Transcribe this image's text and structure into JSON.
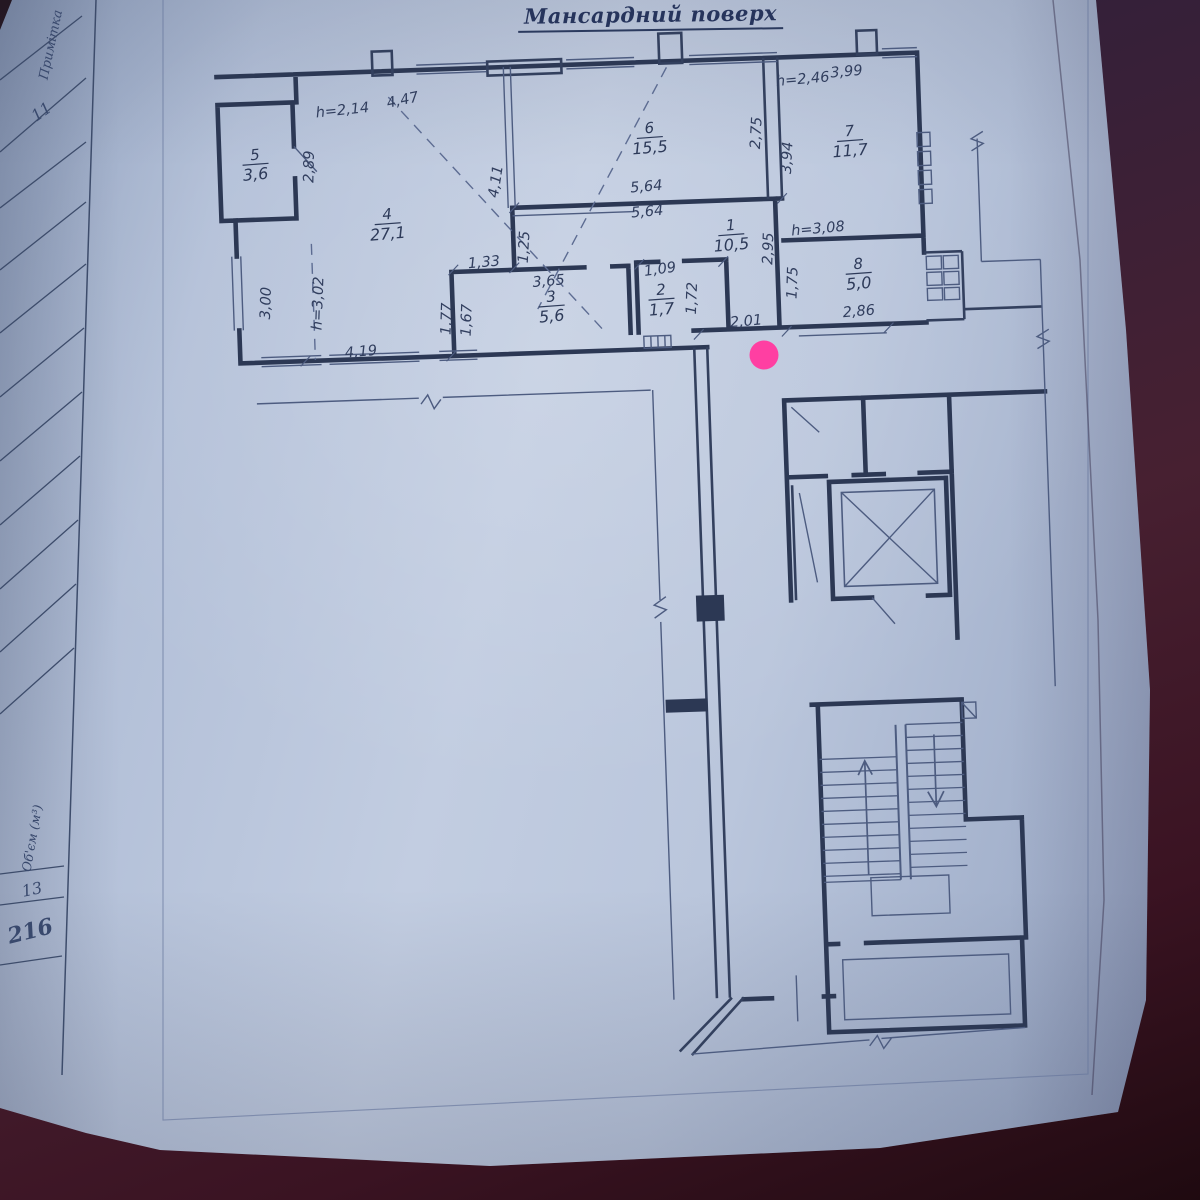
{
  "page": {
    "title": "Мансардний поверх"
  },
  "margin_table": {
    "col_top_header": "Примітка",
    "col_top_number": "11",
    "col_bottom_header": "Об'єм (м³)",
    "col_bottom_number": "13",
    "page_number": "216"
  },
  "plan": {
    "rooms": [
      {
        "num": "5",
        "area": "3,6"
      },
      {
        "num": "4",
        "area": "27,1"
      },
      {
        "num": "6",
        "area": "15,5"
      },
      {
        "num": "7",
        "area": "11,7"
      },
      {
        "num": "1",
        "area": "10,5"
      },
      {
        "num": "3",
        "area": "5,6"
      },
      {
        "num": "2",
        "area": "1,7"
      },
      {
        "num": "8",
        "area": "5,0"
      }
    ],
    "dims": [
      {
        "t": "h=2,14"
      },
      {
        "t": "4,47"
      },
      {
        "t": "2,89"
      },
      {
        "t": "3,00"
      },
      {
        "t": "h=3,02"
      },
      {
        "t": "4,19"
      },
      {
        "t": "4,11"
      },
      {
        "t": "1,25"
      },
      {
        "t": "5,64"
      },
      {
        "t": "5,64"
      },
      {
        "t": "2,75"
      },
      {
        "t": "3,94"
      },
      {
        "t": "h=2,46"
      },
      {
        "t": "3,99"
      },
      {
        "t": "1,33"
      },
      {
        "t": "3,65"
      },
      {
        "t": "1,77"
      },
      {
        "t": "1,67"
      },
      {
        "t": "1,09"
      },
      {
        "t": "1,72"
      },
      {
        "t": "h=3,08"
      },
      {
        "t": "2,95"
      },
      {
        "t": "1,75"
      },
      {
        "t": "2,86"
      },
      {
        "t": "2,01"
      }
    ]
  },
  "annotation": {
    "marker_color": "#ff3fa2"
  }
}
